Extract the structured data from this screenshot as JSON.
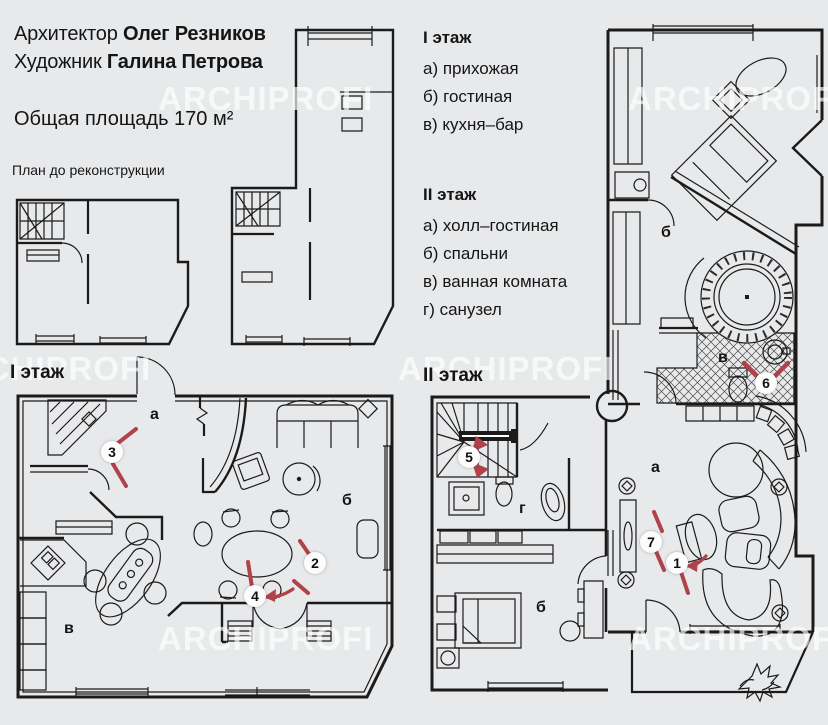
{
  "colors": {
    "background": "#e8e9eb",
    "line": "#1b1b1b",
    "accent_red": "#b04249",
    "marker_fill": "#fcfcfc",
    "watermark": "rgba(255,255,255,0.66)"
  },
  "header": {
    "credit1": {
      "prefix": "Архитектор ",
      "name": "Олег Резников"
    },
    "credit2": {
      "prefix": "Художник ",
      "name": "Галина Петрова"
    },
    "total_area": "Общая площадь 170 м²",
    "before_reconstruction": "План до реконструкции"
  },
  "legend": {
    "floor1": {
      "title": "I этаж",
      "items": [
        "а) прихожая",
        "б) гостиная",
        "в) кухня–бар"
      ]
    },
    "floor2": {
      "title": "II этаж",
      "items": [
        "а) холл–гостиная",
        "б) спальни",
        "в) ванная комната",
        "г) санузел"
      ]
    }
  },
  "plan_titles": {
    "floor1": "I этаж",
    "floor2": "II этаж"
  },
  "room_labels": {
    "floor1": [
      {
        "letter": "а"
      },
      {
        "letter": "б"
      },
      {
        "letter": "в"
      }
    ],
    "floor2": [
      {
        "letter": "б"
      },
      {
        "letter": "в"
      },
      {
        "letter": "а"
      },
      {
        "letter": "г"
      },
      {
        "letter": "б"
      }
    ]
  },
  "markers": [
    "1",
    "2",
    "3",
    "4",
    "5",
    "6",
    "7"
  ],
  "watermark": "ARCHIPROFI"
}
